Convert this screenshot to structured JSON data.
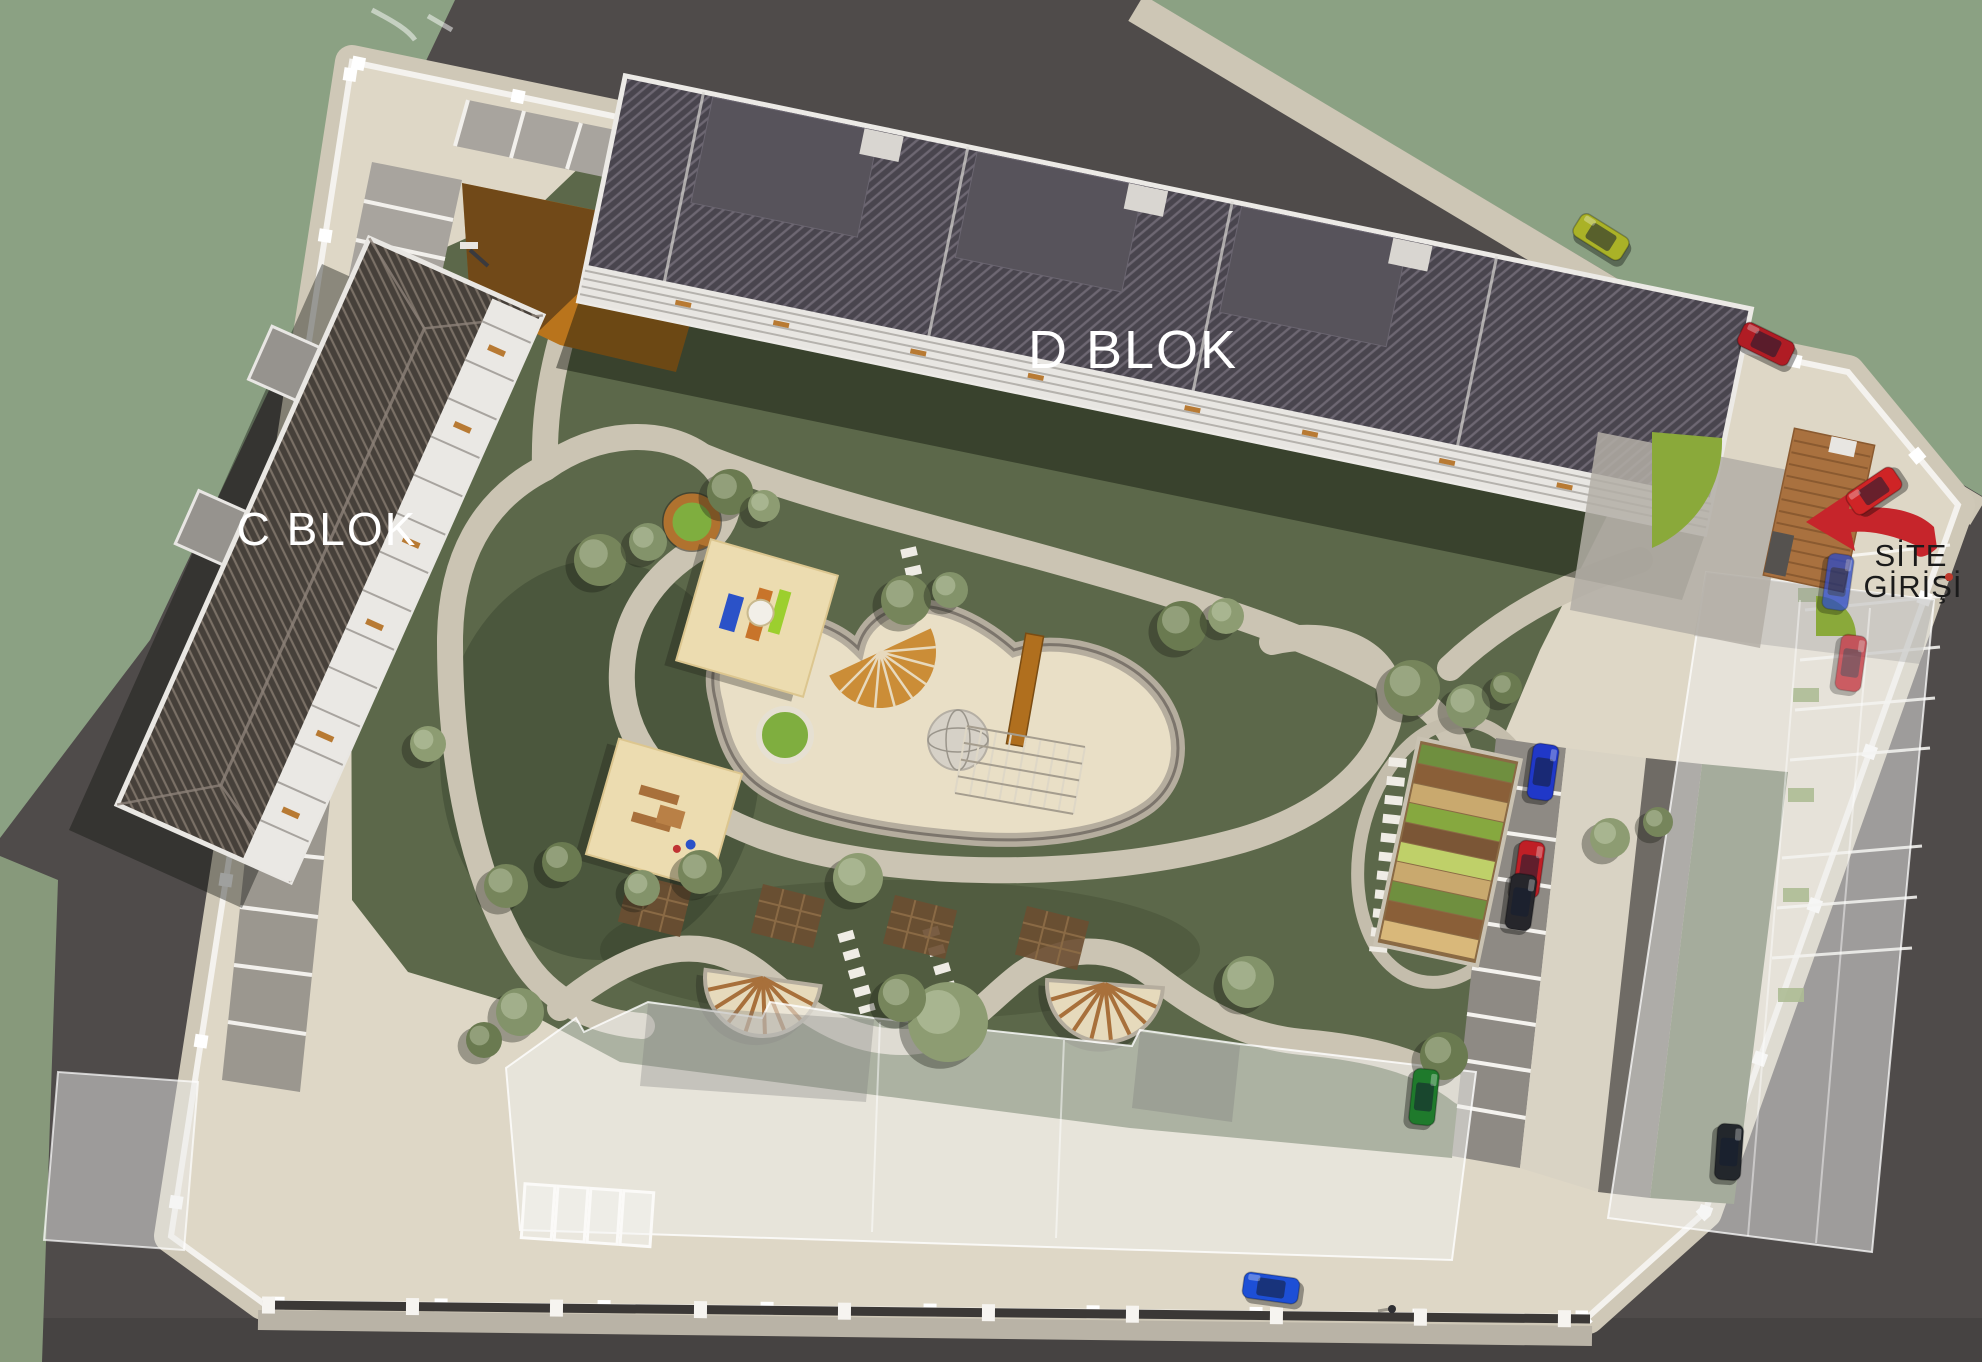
{
  "scene": {
    "type": "aerial-3d-site-plan-render",
    "description": "Bird's-eye architectural rendering of a residential complex with two labeled apartment blocks, central playground, parking areas and marked site entrance"
  },
  "labels": {
    "block_c": "C BLOK",
    "block_d": "D BLOK",
    "entrance_line1": "SİTE",
    "entrance_line2": "GİRİŞİ"
  },
  "icons": {
    "entrance_arrow": "left-arrow-icon"
  },
  "colors": {
    "entrance_arrow": "#c6252b",
    "block_label_text": "#ffffff",
    "entrance_text": "#1b1b1b",
    "road": "#4f4b4a",
    "outside_field": "#8ba183",
    "lawn": "#5c684a",
    "site_ground": "#ded7c6",
    "wall": "#f4f2ee",
    "sand": "#e9dfc6",
    "court_orange": "#b9741c",
    "roof_dark": "#49454e",
    "deck_wood": "#a9713f",
    "lime_lawn": "#8aa93a"
  },
  "trees": [
    [
      600,
      560,
      26
    ],
    [
      648,
      542,
      19
    ],
    [
      730,
      492,
      23
    ],
    [
      764,
      506,
      16
    ],
    [
      906,
      600,
      25
    ],
    [
      950,
      590,
      18
    ],
    [
      1182,
      626,
      25
    ],
    [
      1226,
      616,
      18
    ],
    [
      1412,
      688,
      28
    ],
    [
      1468,
      706,
      22
    ],
    [
      1506,
      688,
      16
    ],
    [
      858,
      878,
      25
    ],
    [
      700,
      872,
      22
    ],
    [
      642,
      888,
      18
    ],
    [
      562,
      862,
      20
    ],
    [
      428,
      744,
      18
    ],
    [
      506,
      886,
      22
    ],
    [
      520,
      1012,
      24
    ],
    [
      484,
      1040,
      18
    ],
    [
      948,
      1022,
      40
    ],
    [
      902,
      998,
      24
    ],
    [
      1248,
      982,
      26
    ],
    [
      1444,
      1056,
      24
    ],
    [
      1610,
      838,
      20
    ],
    [
      1658,
      822,
      15
    ]
  ],
  "cars": [
    {
      "x": 1601,
      "y": 237,
      "rot": 32,
      "color": "#aab227",
      "opacity": 1
    },
    {
      "x": 1766,
      "y": 344,
      "rot": 26,
      "color": "#b01c24",
      "opacity": 1
    },
    {
      "x": 1874,
      "y": 491,
      "rot": -34,
      "color": "#cf2426",
      "opacity": 1
    },
    {
      "x": 1543,
      "y": 772,
      "rot": 98,
      "color": "#2038c8",
      "opacity": 1
    },
    {
      "x": 1529,
      "y": 869,
      "rot": 98,
      "color": "#bf1f26",
      "opacity": 1
    },
    {
      "x": 1521,
      "y": 902,
      "rot": 98,
      "color": "#26262b",
      "opacity": 1
    },
    {
      "x": 1424,
      "y": 1097,
      "rot": 96,
      "color": "#1f7a2c",
      "opacity": 1
    },
    {
      "x": 1271,
      "y": 1288,
      "rot": 8,
      "color": "#1d4fd6",
      "opacity": 1
    },
    {
      "x": 1729,
      "y": 1152,
      "rot": 94,
      "color": "#23272c",
      "opacity": 1
    },
    {
      "x": 1838,
      "y": 582,
      "rot": 98,
      "color": "#2b49c8",
      "opacity": 0.75
    },
    {
      "x": 1851,
      "y": 663,
      "rot": 98,
      "color": "#c02430",
      "opacity": 0.7
    }
  ],
  "people": [
    {
      "x": 1949,
      "y": 577,
      "color": "#c0392b"
    },
    {
      "x": 1392,
      "y": 1309,
      "color": "#2f2f33"
    }
  ]
}
